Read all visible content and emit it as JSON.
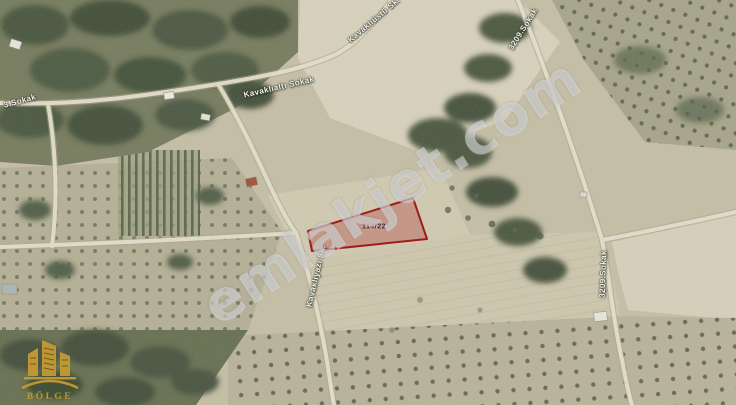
{
  "map": {
    "kind": "satellite-parcel-view",
    "watermark_text": "emlakjet.com",
    "parcel": {
      "label": "114/22",
      "outline_color": "#9e1b1b",
      "fill_color": "#b03a3a"
    },
    "street_labels": [
      {
        "id": "kavaklialti",
        "text": "Kavaklıaltı Sokak"
      },
      {
        "id": "kavakliustu",
        "text": "Kavaklıüstü Sk."
      },
      {
        "id": "sokak-3209-top",
        "text": "3209.Sokak"
      },
      {
        "id": "sokak-3209-right",
        "text": "3209.Sokak"
      },
      {
        "id": "sokak-3-left",
        "text": "3.Sokak"
      },
      {
        "id": "kavakliyazi",
        "text": "Kavaklıyazı Sk."
      }
    ]
  },
  "logo": {
    "name": "BÖLGE",
    "color": "#c49a33"
  }
}
